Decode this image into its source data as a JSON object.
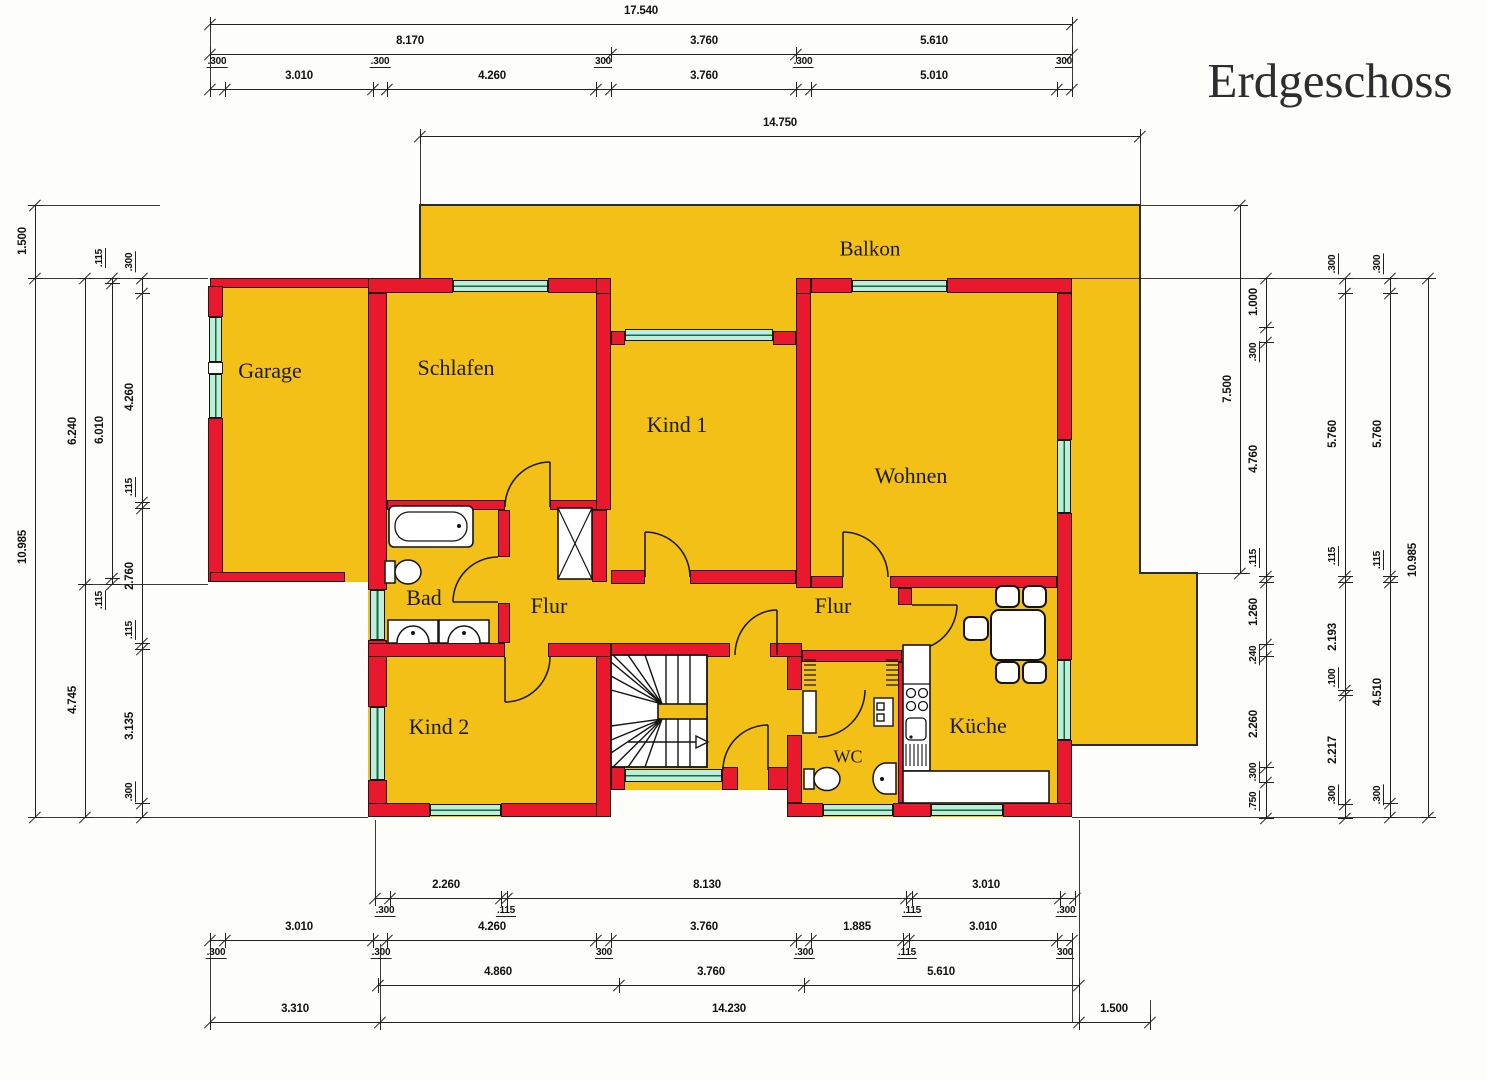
{
  "title": "Erdgeschoss",
  "rooms": [
    {
      "id": "balkon",
      "label": "Balkon",
      "x": 870,
      "y": 249,
      "fs": 21
    },
    {
      "id": "garage",
      "label": "Garage",
      "x": 270,
      "y": 371,
      "fs": 22
    },
    {
      "id": "schlafen",
      "label": "Schlafen",
      "x": 456,
      "y": 368,
      "fs": 22
    },
    {
      "id": "kind1",
      "label": "Kind 1",
      "x": 677,
      "y": 425,
      "fs": 22
    },
    {
      "id": "wohnen",
      "label": "Wohnen",
      "x": 911,
      "y": 476,
      "fs": 22
    },
    {
      "id": "bad",
      "label": "Bad",
      "x": 424,
      "y": 598,
      "fs": 22
    },
    {
      "id": "flur-west",
      "label": "Flur",
      "x": 549,
      "y": 606,
      "fs": 22
    },
    {
      "id": "flur-ost",
      "label": "Flur",
      "x": 833,
      "y": 606,
      "fs": 22
    },
    {
      "id": "kind2",
      "label": "Kind 2",
      "x": 439,
      "y": 727,
      "fs": 22
    },
    {
      "id": "wc",
      "label": "WC",
      "x": 848,
      "y": 757,
      "fs": 18
    },
    {
      "id": "kueche",
      "label": "Küche",
      "x": 978,
      "y": 726,
      "fs": 22
    }
  ],
  "dim_chains": [
    {
      "d": "h",
      "x1": 210,
      "x2": 1072,
      "y": 24,
      "t": [
        210,
        1072
      ],
      "L": [
        {
          "v": "17.540",
          "x": 641,
          "y": 11
        }
      ]
    },
    {
      "d": "h",
      "x1": 210,
      "x2": 1072,
      "y": 54,
      "t": [
        210,
        611,
        796,
        1072
      ],
      "L": [
        {
          "v": "8.170",
          "x": 410,
          "y": 41
        },
        {
          "v": "3.760",
          "x": 704,
          "y": 41
        },
        {
          "v": "5.610",
          "x": 934,
          "y": 41
        }
      ]
    },
    {
      "d": "h",
      "x1": 210,
      "x2": 1072,
      "y": 89,
      "t": [
        210,
        225,
        373,
        387,
        596,
        611,
        796,
        811,
        1057,
        1072
      ],
      "L": [
        {
          "v": ".300",
          "x": 217,
          "y": 62,
          "s": 1
        },
        {
          "v": "3.010",
          "x": 299,
          "y": 76
        },
        {
          "v": ".300",
          "x": 380,
          "y": 62,
          "s": 1
        },
        {
          "v": "4.260",
          "x": 492,
          "y": 76
        },
        {
          "v": "300",
          "x": 603,
          "y": 62,
          "s": 1
        },
        {
          "v": "3.760",
          "x": 704,
          "y": 76
        },
        {
          "v": ".300",
          "x": 803,
          "y": 62,
          "s": 1
        },
        {
          "v": "5.010",
          "x": 934,
          "y": 76
        },
        {
          "v": "300",
          "x": 1064,
          "y": 62,
          "s": 1
        }
      ]
    },
    {
      "d": "h",
      "x1": 420,
      "x2": 1140,
      "y": 136,
      "t": [
        420,
        1140
      ],
      "L": [
        {
          "v": "14.750",
          "x": 780,
          "y": 123
        }
      ]
    },
    {
      "d": "h",
      "x1": 375,
      "x2": 1075,
      "y": 898,
      "t": [
        375,
        390,
        501,
        507,
        906,
        912,
        1060,
        1075
      ],
      "L": [
        {
          "v": "2.260",
          "x": 446,
          "y": 885
        },
        {
          "v": "8.130",
          "x": 707,
          "y": 885
        },
        {
          "v": "3.010",
          "x": 986,
          "y": 885
        },
        {
          "v": ".300",
          "x": 385,
          "y": 911,
          "s": 1
        },
        {
          "v": ".115",
          "x": 506,
          "y": 911,
          "s": 1
        },
        {
          "v": ".115",
          "x": 912,
          "y": 911,
          "s": 1
        },
        {
          "v": ".300",
          "x": 1066,
          "y": 911,
          "s": 1
        }
      ]
    },
    {
      "d": "h",
      "x1": 210,
      "x2": 1072,
      "y": 940,
      "t": [
        210,
        225,
        373,
        387,
        596,
        611,
        796,
        811,
        903,
        909,
        1057,
        1072
      ],
      "L": [
        {
          "v": "3.010",
          "x": 299,
          "y": 927
        },
        {
          "v": "4.260",
          "x": 492,
          "y": 927
        },
        {
          "v": "3.760",
          "x": 704,
          "y": 927
        },
        {
          "v": "1.885",
          "x": 857,
          "y": 927
        },
        {
          "v": "3.010",
          "x": 983,
          "y": 927
        },
        {
          "v": ".300",
          "x": 216,
          "y": 953,
          "s": 1
        },
        {
          "v": ".300",
          "x": 381,
          "y": 953,
          "s": 1
        },
        {
          "v": "300",
          "x": 604,
          "y": 953,
          "s": 1
        },
        {
          "v": ".300",
          "x": 804,
          "y": 953,
          "s": 1
        },
        {
          "v": ".115",
          "x": 907,
          "y": 953,
          "s": 1
        },
        {
          "v": "300",
          "x": 1065,
          "y": 953,
          "s": 1
        }
      ]
    },
    {
      "d": "h",
      "x1": 378,
      "x2": 1079,
      "y": 985,
      "t": [
        378,
        619,
        804,
        1079
      ],
      "L": [
        {
          "v": "4.860",
          "x": 498,
          "y": 972
        },
        {
          "v": "3.760",
          "x": 711,
          "y": 972
        },
        {
          "v": "5.610",
          "x": 941,
          "y": 972
        }
      ]
    },
    {
      "d": "h",
      "x1": 210,
      "x2": 1150,
      "y": 1022,
      "t": [
        210,
        380,
        1079,
        1150
      ],
      "L": [
        {
          "v": "3.310",
          "x": 295,
          "y": 1009
        },
        {
          "v": "14.230",
          "x": 729,
          "y": 1009
        },
        {
          "v": "1.500",
          "x": 1114,
          "y": 1009
        }
      ]
    },
    {
      "d": "v",
      "y1": 205,
      "y2": 817,
      "x": 35,
      "t": [
        205,
        278,
        817
      ],
      "L": [
        {
          "v": "1.500",
          "x": 23,
          "y": 241
        },
        {
          "v": "10.985",
          "x": 23,
          "y": 547
        }
      ]
    },
    {
      "d": "v",
      "y1": 278,
      "y2": 817,
      "x": 85,
      "t": [
        278,
        584,
        817
      ],
      "L": [
        {
          "v": "6.240",
          "x": 73,
          "y": 431
        },
        {
          "v": "4.745",
          "x": 73,
          "y": 700
        }
      ]
    },
    {
      "d": "v",
      "y1": 278,
      "y2": 584,
      "x": 112,
      "t": [
        278,
        283,
        578,
        584
      ],
      "L": [
        {
          "v": ".115",
          "x": 100,
          "y": 258,
          "s": 1
        },
        {
          "v": "6.010",
          "x": 100,
          "y": 430
        },
        {
          "v": ".115",
          "x": 100,
          "y": 600,
          "s": 1
        }
      ]
    },
    {
      "d": "v",
      "y1": 278,
      "y2": 817,
      "x": 142,
      "t": [
        278,
        293,
        502,
        508,
        643,
        649,
        803,
        817
      ],
      "L": [
        {
          "v": ".300",
          "x": 130,
          "y": 262,
          "s": 1
        },
        {
          "v": "4.260",
          "x": 130,
          "y": 397
        },
        {
          "v": ".115",
          "x": 130,
          "y": 487,
          "s": 1
        },
        {
          "v": "2.760",
          "x": 130,
          "y": 576
        },
        {
          "v": ".115",
          "x": 130,
          "y": 630,
          "s": 1
        },
        {
          "v": "3.135",
          "x": 130,
          "y": 726
        },
        {
          "v": ".300",
          "x": 130,
          "y": 792,
          "s": 1
        }
      ]
    },
    {
      "d": "v",
      "y1": 205,
      "y2": 573,
      "x": 1240,
      "t": [
        205,
        573
      ],
      "L": [
        {
          "v": "7.500",
          "x": 1228,
          "y": 389
        }
      ]
    },
    {
      "d": "v",
      "y1": 278,
      "y2": 818,
      "x": 1266,
      "t": [
        278,
        327,
        342,
        576,
        582,
        644,
        656,
        767,
        782,
        818
      ],
      "L": [
        {
          "v": "1.000",
          "x": 1254,
          "y": 302
        },
        {
          "v": ".300",
          "x": 1254,
          "y": 352,
          "s": 1
        },
        {
          "v": "4.760",
          "x": 1254,
          "y": 459
        },
        {
          "v": ".115",
          "x": 1254,
          "y": 558,
          "s": 1
        },
        {
          "v": "1.260",
          "x": 1254,
          "y": 612
        },
        {
          "v": ".240",
          "x": 1254,
          "y": 655,
          "s": 1
        },
        {
          "v": "2.260",
          "x": 1254,
          "y": 724
        },
        {
          "v": ".300",
          "x": 1254,
          "y": 772,
          "s": 1
        },
        {
          "v": ".750",
          "x": 1254,
          "y": 801,
          "s": 1
        }
      ]
    },
    {
      "d": "v",
      "y1": 278,
      "y2": 818,
      "x": 1345,
      "t": [
        278,
        293,
        576,
        582,
        690,
        695,
        804,
        818
      ],
      "L": [
        {
          "v": ".300",
          "x": 1333,
          "y": 264,
          "s": 1
        },
        {
          "v": "5.760",
          "x": 1333,
          "y": 434
        },
        {
          "v": ".115",
          "x": 1333,
          "y": 556,
          "s": 1
        },
        {
          "v": "2.193",
          "x": 1333,
          "y": 637
        },
        {
          "v": ".100",
          "x": 1333,
          "y": 678,
          "s": 1
        },
        {
          "v": "2.217",
          "x": 1333,
          "y": 750
        },
        {
          "v": ".300",
          "x": 1333,
          "y": 795,
          "s": 1
        }
      ]
    },
    {
      "d": "v",
      "y1": 278,
      "y2": 817,
      "x": 1390,
      "t": [
        278,
        293,
        576,
        582,
        803,
        817
      ],
      "L": [
        {
          "v": ".300",
          "x": 1378,
          "y": 264,
          "s": 1
        },
        {
          "v": "5.760",
          "x": 1378,
          "y": 434
        },
        {
          "v": ".115",
          "x": 1378,
          "y": 560,
          "s": 1
        },
        {
          "v": "4.510",
          "x": 1378,
          "y": 692
        },
        {
          "v": ".300",
          "x": 1378,
          "y": 795,
          "s": 1
        }
      ]
    },
    {
      "d": "v",
      "y1": 278,
      "y2": 817,
      "x": 1428,
      "t": [
        278,
        817
      ],
      "L": [
        {
          "v": "10.985",
          "x": 1413,
          "y": 560
        }
      ]
    }
  ]
}
